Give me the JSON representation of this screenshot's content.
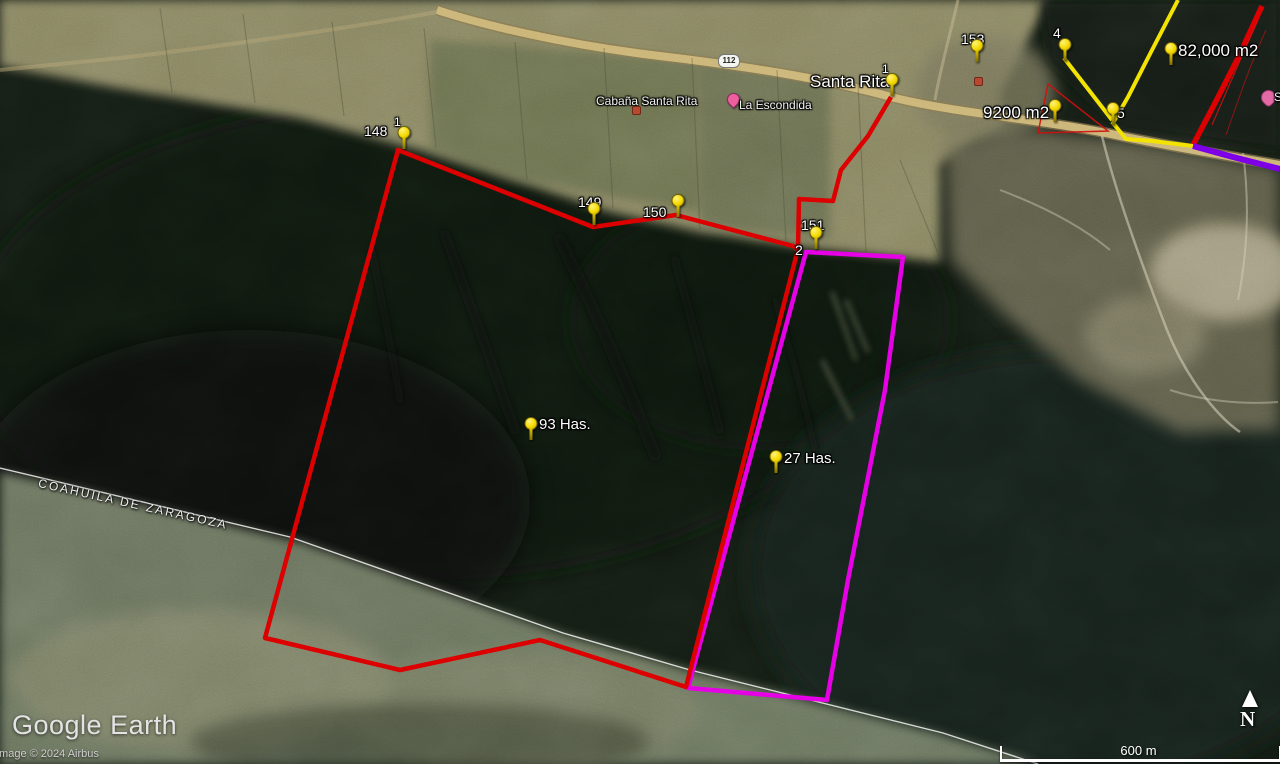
{
  "watermark": {
    "logo": "Google Earth",
    "attribution": "Image © 2024 Airbus"
  },
  "scalebar": {
    "label": "600 m"
  },
  "compass": {
    "label": "N"
  },
  "region_boundary_label": "COAHUILA DE ZARAGOZA",
  "road_shield": "112",
  "pois": {
    "cabana": "Cabaña Santa Rita",
    "escondida": "La Escondida",
    "edge_partial": "S"
  },
  "pins": [
    {
      "label": "148",
      "vertex": "1"
    },
    {
      "label": "Santa Rita",
      "vertex": "1"
    },
    {
      "label": "149"
    },
    {
      "label": "150"
    },
    {
      "label": "151",
      "vertex": "2"
    },
    {
      "label": "153"
    },
    {
      "label": "4"
    },
    {
      "label": "5"
    },
    {
      "label": "82,000 m2"
    },
    {
      "label": "9200 m2"
    },
    {
      "label": "93 Has."
    },
    {
      "label": "27 Has."
    }
  ],
  "parcels": [
    {
      "name": "93 Has.",
      "outline_color": "#dc0000"
    },
    {
      "name": "27 Has.",
      "outline_color": "#e600e6"
    }
  ],
  "overlay_colors": {
    "red": "#dc0000",
    "magenta": "#e600e6",
    "purple": "#7d00e6",
    "yellow": "#f2e400",
    "pin_yellow": "#f4da00",
    "state_line": "#ffffff",
    "road_tan": "#c9b273"
  }
}
